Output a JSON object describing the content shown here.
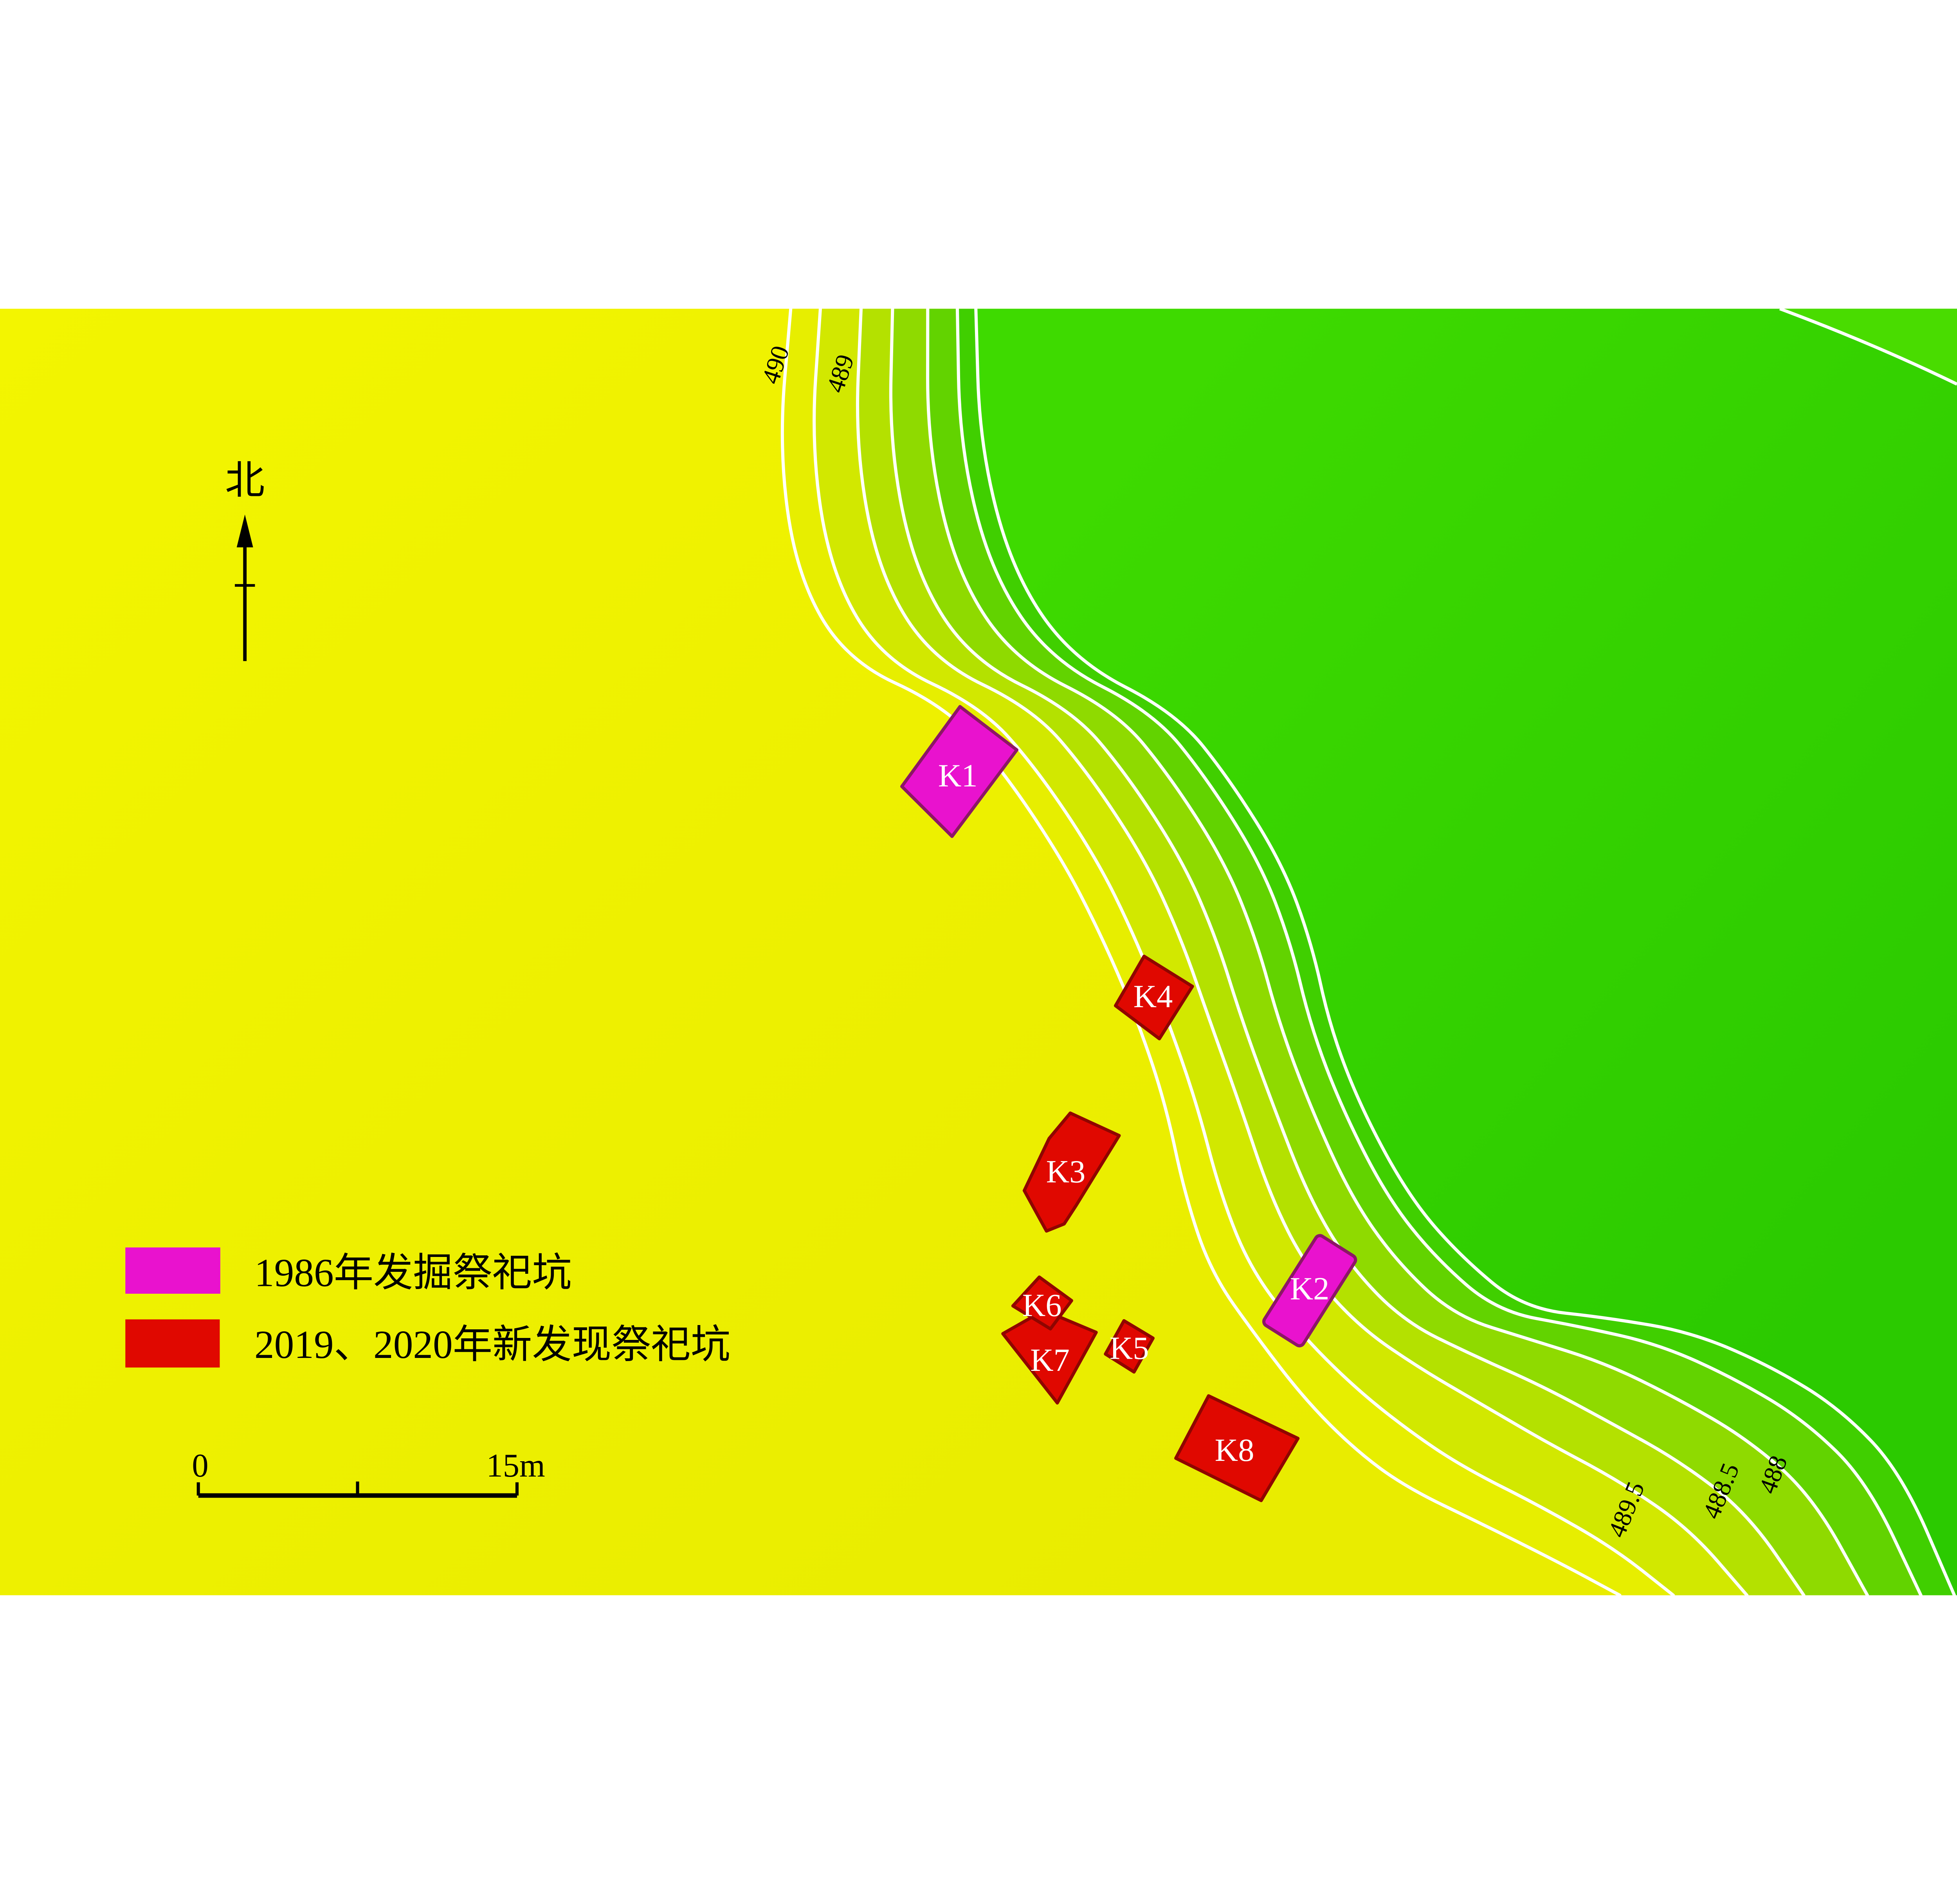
{
  "north": {
    "label": "北"
  },
  "scale_bar": {
    "start": "0",
    "end": "15m"
  },
  "legend": {
    "items": [
      {
        "label": "1986年发掘祭祀坑",
        "color": "#e912ce"
      },
      {
        "label": "2019、2020年新发现祭祀坑",
        "color": "#e00800"
      }
    ]
  },
  "contour_labels": [
    "490",
    "489",
    "489.5",
    "488.5",
    "488"
  ],
  "pits": [
    {
      "label": "K1",
      "type": "1986年发掘祭祀坑"
    },
    {
      "label": "K2",
      "type": "1986年发掘祭祀坑"
    },
    {
      "label": "K3",
      "type": "2019、2020年新发现祭祀坑"
    },
    {
      "label": "K4",
      "type": "2019、2020年新发现祭祀坑"
    },
    {
      "label": "K5",
      "type": "2019、2020年新发现祭祀坑"
    },
    {
      "label": "K6",
      "type": "2019、2020年新发现祭祀坑"
    },
    {
      "label": "K7",
      "type": "2019、2020年新发现祭祀坑"
    },
    {
      "label": "K8",
      "type": "2019、2020年新发现祭祀坑"
    }
  ],
  "colors": {
    "yellow_high": "#f3f500",
    "yellow_low": "#e9ec00",
    "green_near": "#3eda00",
    "green_far": "#2bca00",
    "green_corner": "#49dc00",
    "contour_line": "#ffffff",
    "bands": [
      "#e7ee00",
      "#d2e800",
      "#b4e100",
      "#8fda00",
      "#62d300",
      "#40cf00"
    ],
    "pit_1986_fill": "#e912ce",
    "pit_1986_stroke": "#8c1666",
    "pit_new_fill": "#e00800",
    "pit_new_stroke": "#8f0500",
    "pit_label_text": "#ffffff",
    "map_text": "#000000"
  }
}
